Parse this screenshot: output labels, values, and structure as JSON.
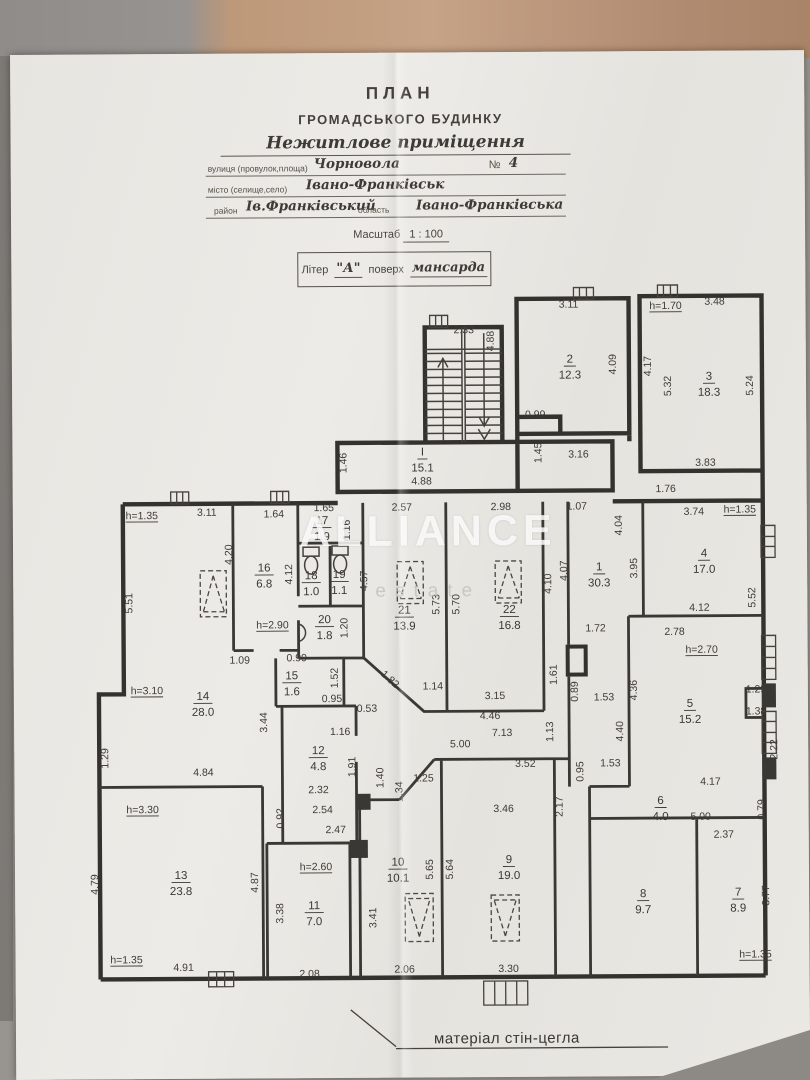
{
  "header": {
    "title1": "ПЛАН",
    "title2": "ГРОМАДСЬКОГО БУДИНКУ",
    "subtitle": "Нежитлове приміщення",
    "street_label": "вулиця (провулок,площа)",
    "street_value": "Чорновола",
    "number_label": "№",
    "number_value": "4",
    "city_label": "місто (селище,село)",
    "city_value": "Івано-Франківськ",
    "district_label": "район",
    "district_value": "Ів.Франківський",
    "region_label": "область",
    "region_value": "Івано-Франківська",
    "scale_prefix": "Масштаб",
    "scale_value": "1 : 100",
    "liter_label": "Літер",
    "liter_value": "\"А\"",
    "floor_label": "поверх",
    "floor_value": "мансарда"
  },
  "watermark": {
    "line1": "ALLIANCE",
    "line2": "estate"
  },
  "footer": {
    "note": "матеріал стін-цегла"
  },
  "plan": {
    "rooms": [
      {
        "n": "2",
        "a": "12.3",
        "x": 568,
        "y": 366
      },
      {
        "n": "3",
        "a": "18.3",
        "x": 707,
        "y": 384
      },
      {
        "n": "I",
        "a": "15.1",
        "x": 420,
        "y": 458
      },
      {
        "n": "1",
        "a": "30.3",
        "x": 596,
        "y": 574
      },
      {
        "n": "4",
        "a": "17.0",
        "x": 701,
        "y": 561
      },
      {
        "n": "16",
        "a": "6.8",
        "x": 261,
        "y": 573
      },
      {
        "n": "17",
        "a": "1.9",
        "x": 319,
        "y": 526
      },
      {
        "n": "18",
        "a": "1.0",
        "x": 308,
        "y": 581
      },
      {
        "n": "19",
        "a": "1.1",
        "x": 336,
        "y": 580
      },
      {
        "n": "20",
        "a": "1.8",
        "x": 321,
        "y": 625
      },
      {
        "n": "21",
        "a": "13.9",
        "x": 401,
        "y": 616
      },
      {
        "n": "22",
        "a": "16.8",
        "x": 506,
        "y": 616
      },
      {
        "n": "14",
        "a": "28.0",
        "x": 199,
        "y": 701
      },
      {
        "n": "15",
        "a": "1.6",
        "x": 288,
        "y": 681
      },
      {
        "n": "5",
        "a": "15.2",
        "x": 686,
        "y": 711
      },
      {
        "n": "12",
        "a": "4.8",
        "x": 314,
        "y": 756
      },
      {
        "n": "6",
        "a": "4.0",
        "x": 656,
        "y": 808
      },
      {
        "n": "13",
        "a": "23.8",
        "x": 176,
        "y": 880
      },
      {
        "n": "11",
        "a": "7.0",
        "x": 309,
        "y": 911
      },
      {
        "n": "10",
        "a": "10.1",
        "x": 393,
        "y": 868
      },
      {
        "n": "9",
        "a": "19.0",
        "x": 504,
        "y": 866
      },
      {
        "n": "8",
        "a": "9.7",
        "x": 638,
        "y": 901
      },
      {
        "n": "7",
        "a": "8.9",
        "x": 733,
        "y": 900
      }
    ],
    "dims": [
      {
        "t": "2.33",
        "x": 462,
        "y": 336
      },
      {
        "t": "4.88",
        "x": 492,
        "y": 344,
        "r": -90
      },
      {
        "t": "3.11",
        "x": 567,
        "y": 311
      },
      {
        "t": "4.09",
        "x": 614,
        "y": 368,
        "r": -90
      },
      {
        "t": "h=1.70",
        "x": 664,
        "y": 313,
        "u": 1
      },
      {
        "t": "3.48",
        "x": 713,
        "y": 309
      },
      {
        "t": "4.17",
        "x": 649,
        "y": 370,
        "r": -90
      },
      {
        "t": "5.32",
        "x": 669,
        "y": 390,
        "r": -90
      },
      {
        "t": "5.24",
        "x": 751,
        "y": 390,
        "r": -90
      },
      {
        "t": "3.83",
        "x": 703,
        "y": 470
      },
      {
        "t": "1.76",
        "x": 663,
        "y": 496
      },
      {
        "t": "0.99",
        "x": 533,
        "y": 421
      },
      {
        "t": "1.45",
        "x": 539,
        "y": 456,
        "r": -90
      },
      {
        "t": "3.16",
        "x": 576,
        "y": 461
      },
      {
        "t": "1.46",
        "x": 344,
        "y": 465,
        "r": -90
      },
      {
        "t": "4.88",
        "x": 419,
        "y": 487
      },
      {
        "t": "1.64",
        "x": 271,
        "y": 519
      },
      {
        "t": "1.65",
        "x": 321,
        "y": 513
      },
      {
        "t": "1.16",
        "x": 347,
        "y": 532,
        "r": -90
      },
      {
        "t": "2.57",
        "x": 399,
        "y": 513
      },
      {
        "t": "2.98",
        "x": 498,
        "y": 513
      },
      {
        "t": "1.07",
        "x": 574,
        "y": 513
      },
      {
        "t": "h=1.35",
        "x": 139,
        "y": 520,
        "u": 1
      },
      {
        "t": "3.11",
        "x": 204,
        "y": 517
      },
      {
        "t": "4.20",
        "x": 229,
        "y": 556,
        "r": -90
      },
      {
        "t": "4.12",
        "x": 289,
        "y": 576,
        "r": -90
      },
      {
        "t": "4.57",
        "x": 364,
        "y": 583,
        "r": -90
      },
      {
        "t": "4.04",
        "x": 619,
        "y": 529,
        "r": -90
      },
      {
        "t": "3.95",
        "x": 634,
        "y": 572,
        "r": -90
      },
      {
        "t": "3.74",
        "x": 691,
        "y": 519
      },
      {
        "t": "h=1.35",
        "x": 737,
        "y": 517,
        "u": 1
      },
      {
        "t": "5.52",
        "x": 752,
        "y": 602,
        "r": -90
      },
      {
        "t": "5.51",
        "x": 129,
        "y": 604,
        "r": -90
      },
      {
        "t": "5.73",
        "x": 436,
        "y": 607,
        "r": -90
      },
      {
        "t": "5.70",
        "x": 456,
        "y": 607,
        "r": -90
      },
      {
        "t": "4.10",
        "x": 548,
        "y": 587,
        "r": -90
      },
      {
        "t": "4.07",
        "x": 564,
        "y": 574,
        "r": -90
      },
      {
        "t": "h=2.90",
        "x": 269,
        "y": 630,
        "u": 1
      },
      {
        "t": "1.20",
        "x": 344,
        "y": 630,
        "r": -90
      },
      {
        "t": "4.12",
        "x": 696,
        "y": 615
      },
      {
        "t": "1.72",
        "x": 592,
        "y": 635
      },
      {
        "t": "2.78",
        "x": 671,
        "y": 639
      },
      {
        "t": "h=2.70",
        "x": 698,
        "y": 657,
        "u": 1
      },
      {
        "t": "1.09",
        "x": 236,
        "y": 665
      },
      {
        "t": "0.99",
        "x": 293,
        "y": 663
      },
      {
        "t": "1.61",
        "x": 553,
        "y": 678,
        "r": -90
      },
      {
        "t": "0.89",
        "x": 574,
        "y": 695,
        "r": -90
      },
      {
        "t": "h=3.10",
        "x": 143,
        "y": 695,
        "u": 1
      },
      {
        "t": "1.52",
        "x": 334,
        "y": 680,
        "r": -90
      },
      {
        "t": "1.82",
        "x": 384,
        "y": 684,
        "r": 42
      },
      {
        "t": "1.14",
        "x": 429,
        "y": 692
      },
      {
        "t": "3.15",
        "x": 491,
        "y": 702
      },
      {
        "t": "4.36",
        "x": 633,
        "y": 694,
        "r": -90
      },
      {
        "t": "1.29",
        "x": 752,
        "y": 697
      },
      {
        "t": "0.95",
        "x": 328,
        "y": 704
      },
      {
        "t": "0.53",
        "x": 363,
        "y": 714
      },
      {
        "t": "1.53",
        "x": 600,
        "y": 704
      },
      {
        "t": "4.46",
        "x": 486,
        "y": 722
      },
      {
        "t": "7.13",
        "x": 498,
        "y": 739
      },
      {
        "t": "1.13",
        "x": 549,
        "y": 735,
        "r": -90
      },
      {
        "t": "1.38",
        "x": 752,
        "y": 719
      },
      {
        "t": "3.44",
        "x": 263,
        "y": 724,
        "r": -90
      },
      {
        "t": "1.16",
        "x": 336,
        "y": 737
      },
      {
        "t": "4.40",
        "x": 619,
        "y": 735,
        "r": -90
      },
      {
        "t": "5.00",
        "x": 456,
        "y": 750
      },
      {
        "t": "2.22",
        "x": 773,
        "y": 754,
        "r": -90
      },
      {
        "t": "1.29",
        "x": 104,
        "y": 759,
        "r": -90
      },
      {
        "t": "3.52",
        "x": 521,
        "y": 770
      },
      {
        "t": "1.91",
        "x": 351,
        "y": 769,
        "r": -90
      },
      {
        "t": "1.53",
        "x": 606,
        "y": 770
      },
      {
        "t": "0.95",
        "x": 579,
        "y": 775,
        "r": -90
      },
      {
        "t": "4.84",
        "x": 199,
        "y": 777
      },
      {
        "t": "1.40",
        "x": 379,
        "y": 780,
        "r": -90
      },
      {
        "t": "1.25",
        "x": 419,
        "y": 784
      },
      {
        "t": "4.17",
        "x": 706,
        "y": 789
      },
      {
        "t": "1.34",
        "x": 398,
        "y": 794,
        "r": -90
      },
      {
        "t": "2.32",
        "x": 314,
        "y": 795
      },
      {
        "t": "0.79",
        "x": 760,
        "y": 814,
        "r": -90
      },
      {
        "t": "h=3.30",
        "x": 138,
        "y": 814,
        "u": 1
      },
      {
        "t": "2.54",
        "x": 318,
        "y": 815
      },
      {
        "t": "3.46",
        "x": 499,
        "y": 815
      },
      {
        "t": "5.00",
        "x": 696,
        "y": 824
      },
      {
        "t": "0.92",
        "x": 279,
        "y": 820,
        "r": -90
      },
      {
        "t": "2.17",
        "x": 558,
        "y": 810,
        "r": -90
      },
      {
        "t": "2.47",
        "x": 331,
        "y": 835
      },
      {
        "t": "2.37",
        "x": 719,
        "y": 842
      },
      {
        "t": "h=2.60",
        "x": 311,
        "y": 872,
        "u": 1
      },
      {
        "t": "5.65",
        "x": 428,
        "y": 872,
        "r": -90
      },
      {
        "t": "5.64",
        "x": 448,
        "y": 872,
        "r": -90
      },
      {
        "t": "4.79",
        "x": 93,
        "y": 885,
        "r": -90
      },
      {
        "t": "4.87",
        "x": 253,
        "y": 884,
        "r": -90
      },
      {
        "t": "3.77",
        "x": 764,
        "y": 900,
        "r": -90
      },
      {
        "t": "3.38",
        "x": 278,
        "y": 915,
        "r": -90
      },
      {
        "t": "3.41",
        "x": 371,
        "y": 920,
        "r": -90
      },
      {
        "t": "h=1.35",
        "x": 121,
        "y": 964,
        "u": 1
      },
      {
        "t": "h=1.35",
        "x": 750,
        "y": 962,
        "u": 1
      },
      {
        "t": "4.91",
        "x": 178,
        "y": 972
      },
      {
        "t": "2.06",
        "x": 399,
        "y": 975
      },
      {
        "t": "3.30",
        "x": 503,
        "y": 975
      },
      {
        "t": "2.08",
        "x": 304,
        "y": 979
      }
    ]
  }
}
